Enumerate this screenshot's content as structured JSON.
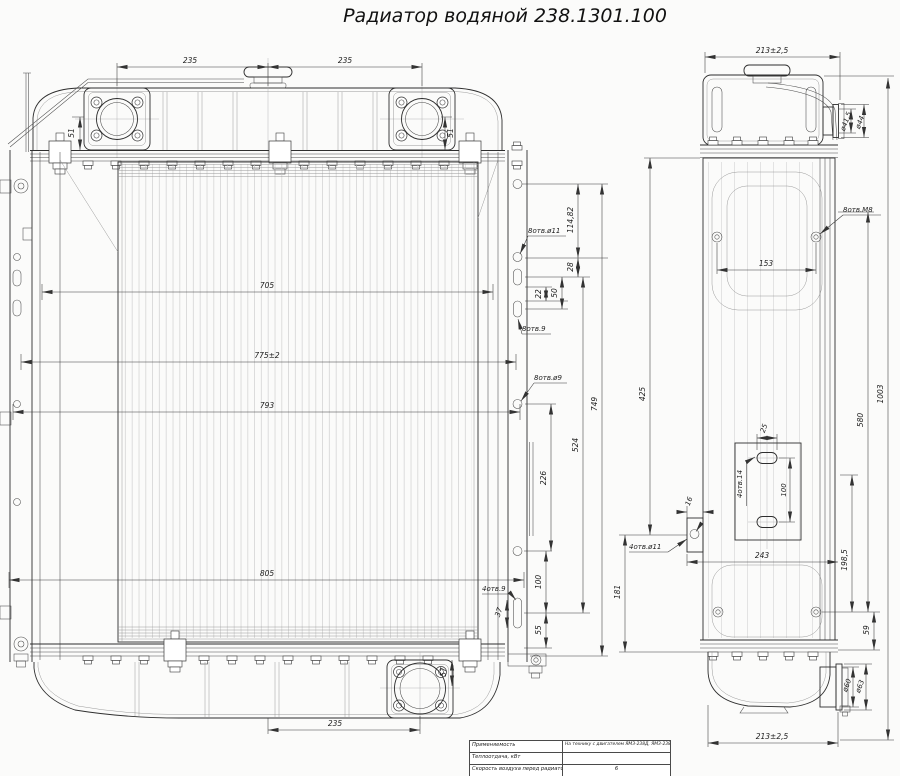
{
  "title": "Радиатор водяной 238.1301.100",
  "front": {
    "dim_235_left": "235",
    "dim_235_right": "235",
    "dim_51_left": "51",
    "dim_51_right": "51",
    "dim_705": "705",
    "dim_775": "775±2",
    "dim_793": "793",
    "dim_805": "805",
    "holes_8_d11": "8отв.ø11",
    "dim_114_82": "114,82",
    "dim_28": "28",
    "dim_50": "50",
    "dim_22": "22",
    "holes_8_9": "8отв.9",
    "holes_8_d9": "8отв.ø9",
    "dim_749": "749",
    "dim_524": "524",
    "dim_226": "226",
    "holes_4_9": "4отв.9",
    "dim_37": "37",
    "dim_100": "100",
    "dim_55": "55",
    "dim_57": "57",
    "dim_235_bottom": "235"
  },
  "side": {
    "dim_213_top": "213±2,5",
    "dim_d41_5": "ø41,5",
    "dim_d44": "ø44",
    "holes_8_m8": "8отв.М8",
    "dim_153": "153",
    "dim_425": "425",
    "dim_16": "16",
    "holes_4_d11": "4отв.ø11",
    "dim_243": "243",
    "dim_181": "181",
    "dim_25": "25",
    "holes_4_14": "4отв.14",
    "dim_100": "100",
    "dim_580": "580",
    "dim_1003": "1003",
    "dim_198_5": "198,5",
    "dim_59": "59",
    "dim_d60": "ø60",
    "dim_d63": "ø63",
    "dim_213_bottom": "213±2,5"
  },
  "spec_table": {
    "rows": [
      {
        "label": "Применяемость",
        "value": "На технику с двигателем ЯМЗ-238Д, ЯМЗ-238 ДК"
      },
      {
        "label": "Теплоотдача, кВт",
        "value": ""
      },
      {
        "label": "Скорость воздуха перед радиатором, м/с",
        "value": "6"
      }
    ]
  }
}
